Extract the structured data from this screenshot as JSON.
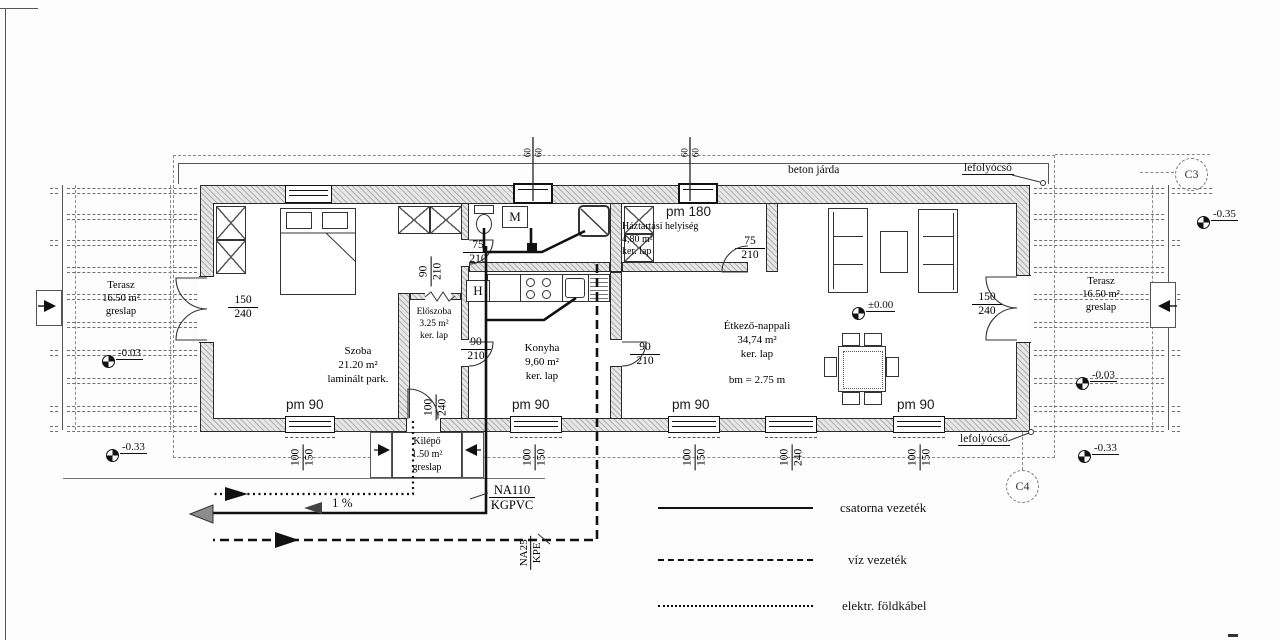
{
  "rooms": {
    "szoba": {
      "name": "Szoba",
      "area": "21.20 m²",
      "floor": "laminált park."
    },
    "eloszoba": {
      "name": "Előszoba",
      "area": "3.25 m²",
      "floor": "ker. lap"
    },
    "konyha": {
      "name": "Konyha",
      "area": "9,60 m²",
      "floor": "ker. lap"
    },
    "haztartasi": {
      "name": "Háztartási helyiség",
      "area": "4,80 m²",
      "floor": "ker. lap",
      "pm": "pm 180"
    },
    "etkezo": {
      "name": "Étkező-nappali",
      "area": "34,74 m²",
      "floor": "ker. lap",
      "height": "bm = 2.75 m"
    },
    "terasz": {
      "name": "Terasz",
      "area": "16.50 m²",
      "floor": "greslap"
    },
    "kilepo": {
      "name": "Kilépő",
      "area": "1.50 m²",
      "floor": "greslap"
    }
  },
  "dims": {
    "pm90": "pm 90",
    "d150_240": {
      "n": "150",
      "d": "240"
    },
    "d90_210": {
      "n": "90",
      "d": "210"
    },
    "d75_210": {
      "n": "75",
      "d": "210"
    },
    "d100_150": {
      "n": "100",
      "d": "150"
    },
    "d100_240": {
      "n": "100",
      "d": "240"
    },
    "d60_60": {
      "n": "60",
      "d": "60"
    },
    "na110": {
      "n": "NA110",
      "d": "KGPVC"
    },
    "na25": {
      "n": "NA25",
      "d": "KPE"
    },
    "slope": "1 %"
  },
  "levels": {
    "zero": "±0.00",
    "m003": "-0.03",
    "m033": "-0.33",
    "m035": "-0.35"
  },
  "annotations": {
    "beton_jarda": "beton járda",
    "lefolyocso": "lefolyócső",
    "c3": "C3",
    "c4": "C4",
    "washing_machine": "M",
    "fridge": "H"
  },
  "legend": [
    {
      "style": "solid",
      "label": "csatorna vezeték"
    },
    {
      "style": "dashed",
      "label": "víz vezeték"
    },
    {
      "style": "dotted",
      "label": "elektr. földkábel"
    }
  ],
  "colors": {
    "line": "#111111",
    "wall_hatch": "#adadad",
    "gray_arrow": "#8c8c8c"
  }
}
